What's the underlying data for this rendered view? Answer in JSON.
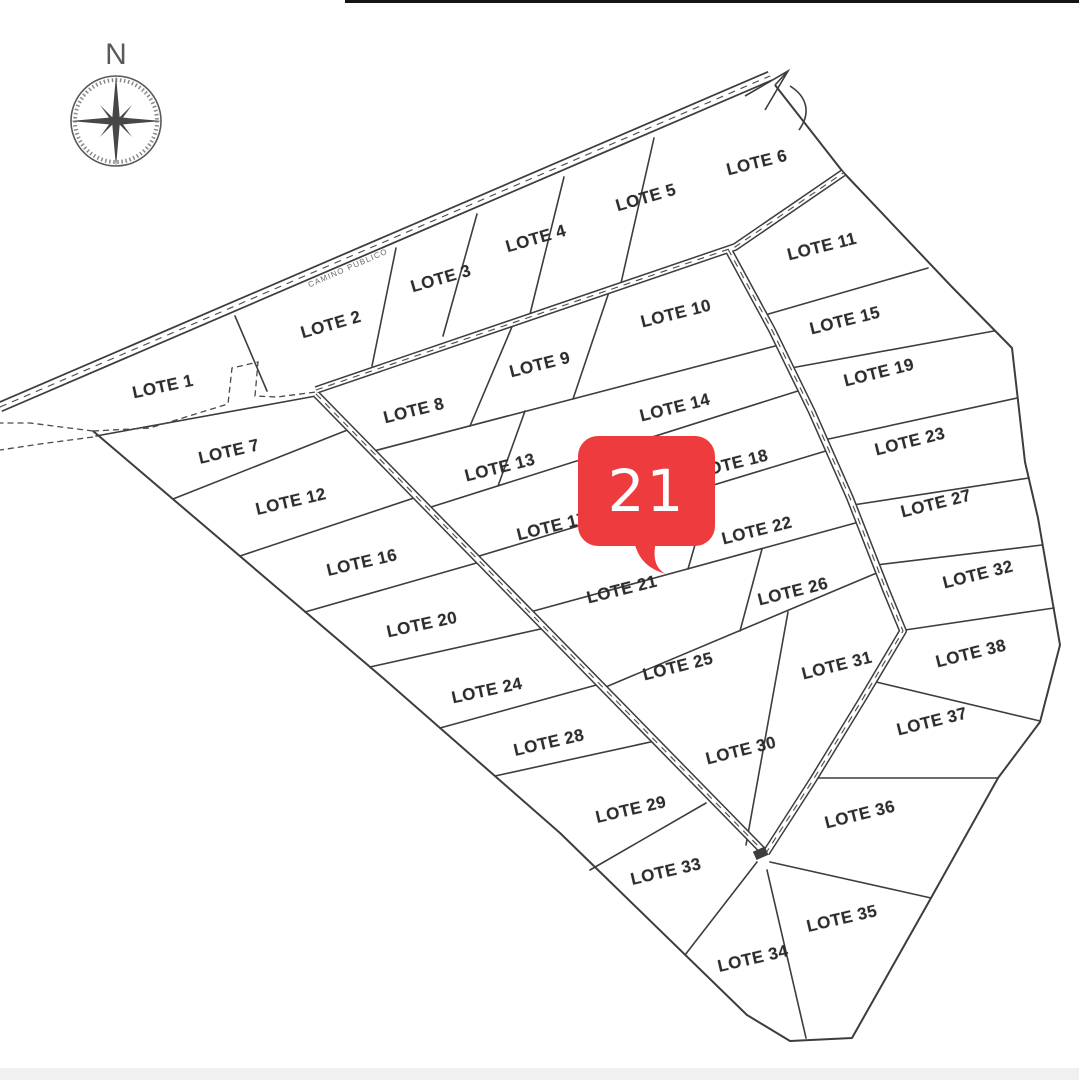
{
  "page": {
    "background": "#ffffff",
    "bottom_strip_color": "#f0f0f1"
  },
  "compass": {
    "north_label": "N"
  },
  "road": {
    "name": "CAMINO PUBLICO"
  },
  "marker": {
    "value": "21",
    "color": "#ed3b3e",
    "text_color": "#ffffff",
    "refers_to": "LOTE 21"
  },
  "lots": [
    {
      "id": 1,
      "label": "LOTE 1",
      "x": 163,
      "y": 387,
      "rot": -12
    },
    {
      "id": 2,
      "label": "LOTE 2",
      "x": 331,
      "y": 325,
      "rot": -16
    },
    {
      "id": 3,
      "label": "LOTE 3",
      "x": 441,
      "y": 279,
      "rot": -16
    },
    {
      "id": 4,
      "label": "LOTE 4",
      "x": 536,
      "y": 239,
      "rot": -16
    },
    {
      "id": 5,
      "label": "LOTE 5",
      "x": 646,
      "y": 198,
      "rot": -16
    },
    {
      "id": 6,
      "label": "LOTE 6",
      "x": 757,
      "y": 163,
      "rot": -14
    },
    {
      "id": 7,
      "label": "LOTE 7",
      "x": 229,
      "y": 452,
      "rot": -13
    },
    {
      "id": 8,
      "label": "LOTE 8",
      "x": 414,
      "y": 411,
      "rot": -14
    },
    {
      "id": 9,
      "label": "LOTE 9",
      "x": 540,
      "y": 365,
      "rot": -14
    },
    {
      "id": 10,
      "label": "LOTE 10",
      "x": 676,
      "y": 314,
      "rot": -14
    },
    {
      "id": 11,
      "label": "LOTE 11",
      "x": 822,
      "y": 247,
      "rot": -14
    },
    {
      "id": 12,
      "label": "LOTE 12",
      "x": 291,
      "y": 502,
      "rot": -13
    },
    {
      "id": 13,
      "label": "LOTE 13",
      "x": 500,
      "y": 468,
      "rot": -14
    },
    {
      "id": 14,
      "label": "LOTE 14",
      "x": 675,
      "y": 408,
      "rot": -14
    },
    {
      "id": 15,
      "label": "LOTE 15",
      "x": 845,
      "y": 321,
      "rot": -14
    },
    {
      "id": 16,
      "label": "LOTE 16",
      "x": 362,
      "y": 563,
      "rot": -13
    },
    {
      "id": 17,
      "label": "LOTE 17",
      "x": 552,
      "y": 527,
      "rot": -14
    },
    {
      "id": 18,
      "label": "LOTE 18",
      "x": 733,
      "y": 464,
      "rot": -14
    },
    {
      "id": 19,
      "label": "LOTE 19",
      "x": 879,
      "y": 373,
      "rot": -14
    },
    {
      "id": 20,
      "label": "LOTE 20",
      "x": 422,
      "y": 625,
      "rot": -12
    },
    {
      "id": 21,
      "label": "LOTE 21",
      "x": 622,
      "y": 590,
      "rot": -14
    },
    {
      "id": 22,
      "label": "LOTE 22",
      "x": 757,
      "y": 531,
      "rot": -14
    },
    {
      "id": 23,
      "label": "LOTE 23",
      "x": 910,
      "y": 442,
      "rot": -14
    },
    {
      "id": 24,
      "label": "LOTE 24",
      "x": 487,
      "y": 691,
      "rot": -12
    },
    {
      "id": 25,
      "label": "LOTE 25",
      "x": 678,
      "y": 667,
      "rot": -14
    },
    {
      "id": 26,
      "label": "LOTE 26",
      "x": 793,
      "y": 592,
      "rot": -14
    },
    {
      "id": 27,
      "label": "LOTE 27",
      "x": 936,
      "y": 504,
      "rot": -14
    },
    {
      "id": 28,
      "label": "LOTE 28",
      "x": 549,
      "y": 743,
      "rot": -13
    },
    {
      "id": 29,
      "label": "LOTE 29",
      "x": 631,
      "y": 810,
      "rot": -13
    },
    {
      "id": 30,
      "label": "LOTE 30",
      "x": 741,
      "y": 751,
      "rot": -14
    },
    {
      "id": 31,
      "label": "LOTE 31",
      "x": 837,
      "y": 666,
      "rot": -14
    },
    {
      "id": 32,
      "label": "LOTE 32",
      "x": 978,
      "y": 575,
      "rot": -14
    },
    {
      "id": 33,
      "label": "LOTE 33",
      "x": 666,
      "y": 872,
      "rot": -13
    },
    {
      "id": 34,
      "label": "LOTE 34",
      "x": 753,
      "y": 959,
      "rot": -13
    },
    {
      "id": 35,
      "label": "LOTE 35",
      "x": 842,
      "y": 919,
      "rot": -13
    },
    {
      "id": 36,
      "label": "LOTE 36",
      "x": 860,
      "y": 815,
      "rot": -14
    },
    {
      "id": 37,
      "label": "LOTE 37",
      "x": 932,
      "y": 722,
      "rot": -14
    },
    {
      "id": 38,
      "label": "LOTE 38",
      "x": 971,
      "y": 654,
      "rot": -14
    }
  ]
}
